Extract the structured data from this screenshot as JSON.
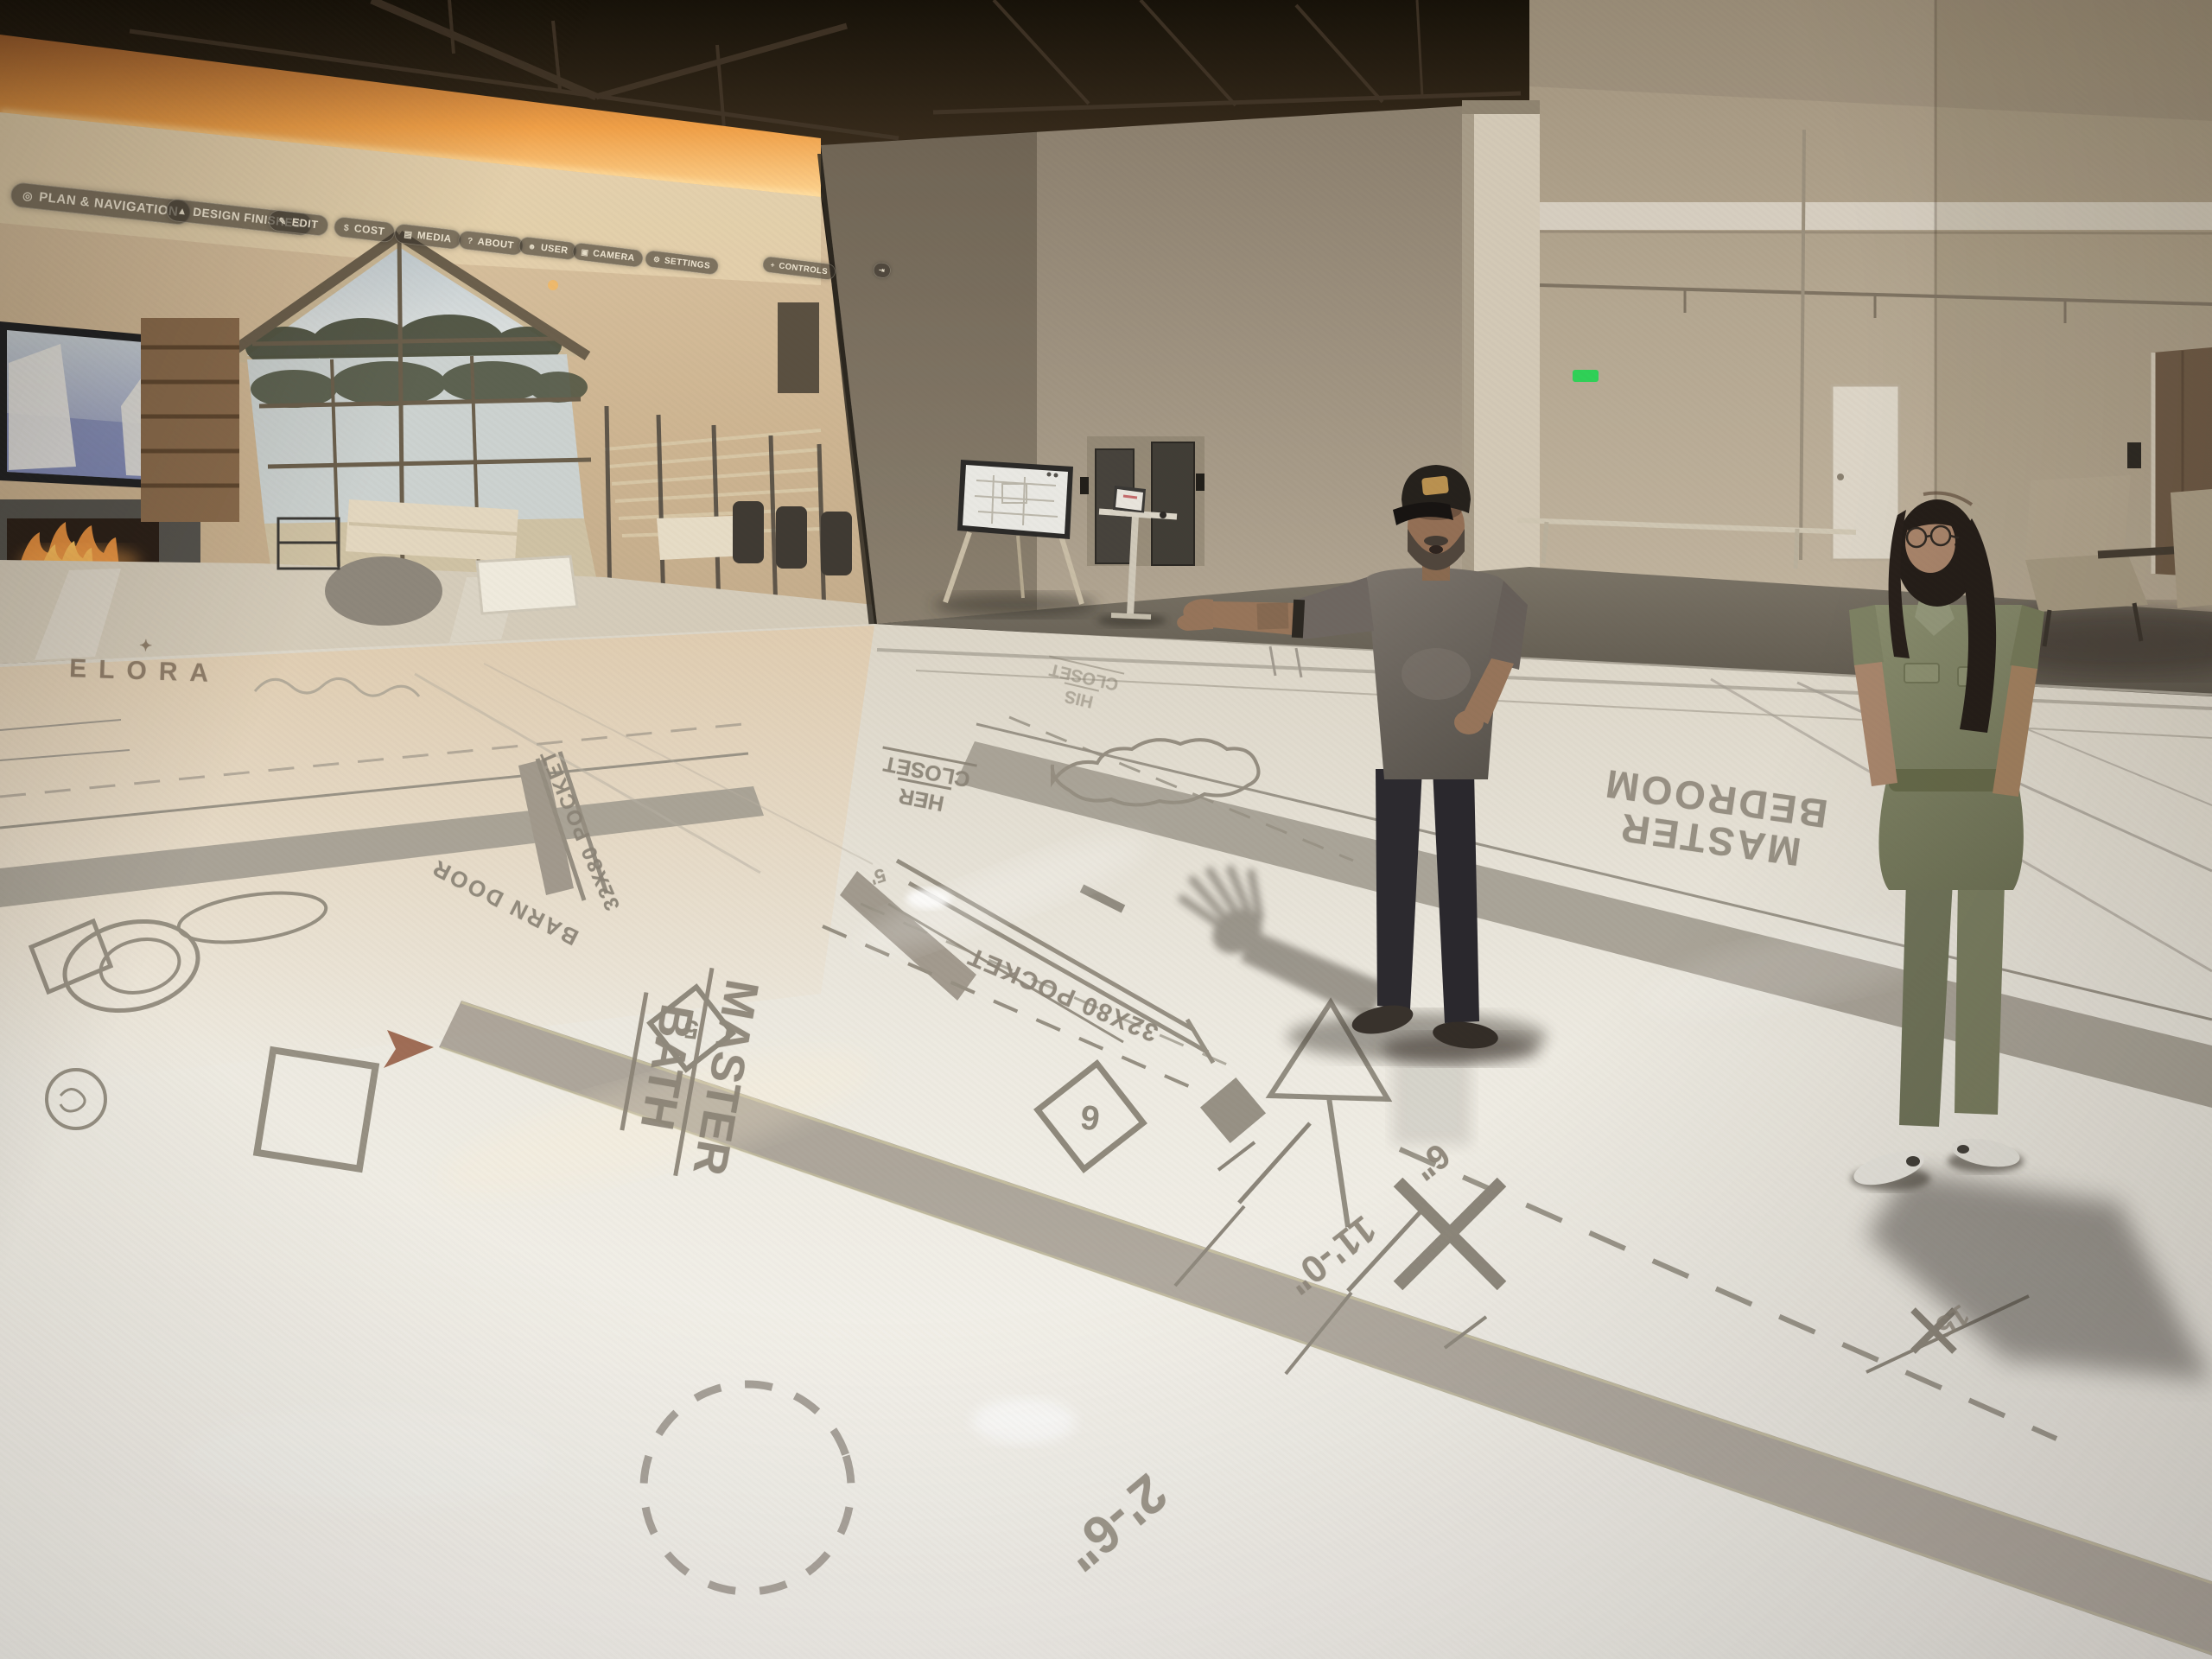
{
  "wall_menu": {
    "items": [
      {
        "icon": "◎",
        "label": "PLAN & NAVIGATION"
      },
      {
        "icon": "▲",
        "label": "DESIGN FINISHES"
      },
      {
        "icon": "✎",
        "label": "EDIT"
      },
      {
        "icon": "$",
        "label": "COST"
      },
      {
        "icon": "▤",
        "label": "MEDIA"
      },
      {
        "icon": "?",
        "label": "ABOUT"
      },
      {
        "icon": "☻",
        "label": "USER"
      },
      {
        "icon": "▣",
        "label": "CAMERA"
      },
      {
        "icon": "⚙",
        "label": "SETTINGS"
      },
      {
        "icon": "+",
        "label": "CONTROLS"
      },
      {
        "icon": "⇥",
        "label": ""
      }
    ]
  },
  "brand": {
    "logo_icon": "✦",
    "logo_text": "ELORA"
  },
  "blueprint": {
    "rooms": {
      "master_bath": {
        "w1": "MASTER",
        "w2": "BATH"
      },
      "master_bedroom": {
        "w1": "MASTER",
        "w2": "BEDROOM"
      },
      "her_closet": {
        "w1": "HER",
        "w2": "CLOSET"
      },
      "his_closet": {
        "w1": "HIS",
        "w2": "CLOSET"
      }
    },
    "doors": {
      "barn": "BARN DOOR",
      "pocket": "32X80 POCKET"
    },
    "dimensions": {
      "bath_door": "2'-6\"",
      "bedroom": "11'-0\"",
      "offset": "6\"",
      "minor": "5'",
      "edge": "15'"
    },
    "keynotes": {
      "n5": "5",
      "n6": "6"
    }
  },
  "colors": {
    "cove_glow": "#f2a94f",
    "blueprint_ink": "#8a8477",
    "wall_tan": "#b5a894",
    "jumpsuit_olive": "#7d8160",
    "exit_light_green": "#3bd65a"
  }
}
